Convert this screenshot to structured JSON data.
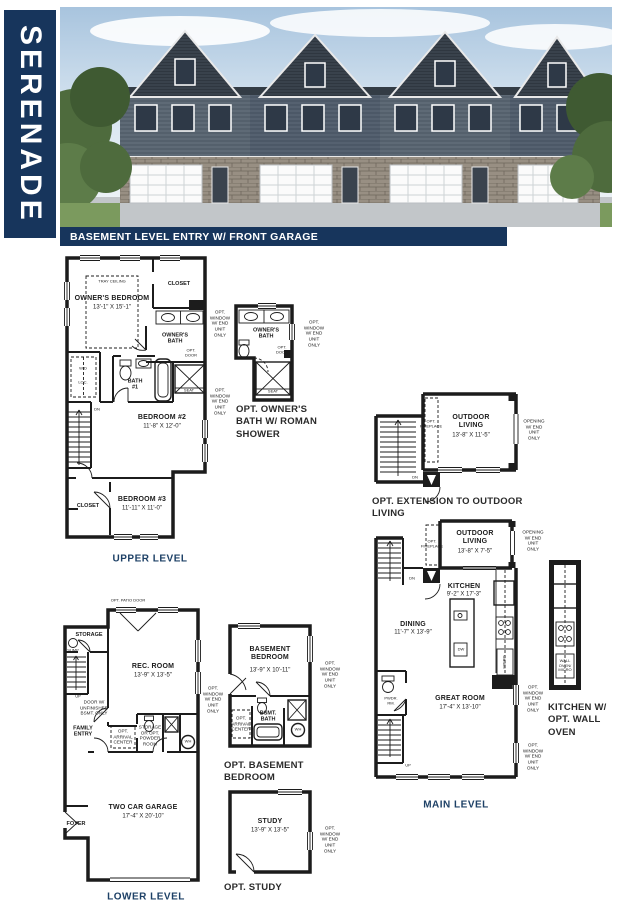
{
  "title": "SERENADE",
  "banner": "BASEMENT LEVEL ENTRY W/ FRONT GARAGE",
  "colors": {
    "navy": "#17355c",
    "caption_blue": "#1d4066"
  },
  "upper": {
    "caption": "UPPER LEVEL",
    "tray_ceiling": "TRAY CEILING",
    "owners_bedroom": "OWNER'S BEDROOM",
    "owners_bedroom_dims": "13'-1\" X 15'-1\"",
    "closet_top": "CLOSET",
    "owners_bath": "OWNER'S\nBATH",
    "opt_door": "OPT.\nDOOR",
    "seat": "SEAT",
    "wd": "W/D",
    "loc": "LOC.",
    "bath1": "BATH\n#1",
    "dn": "DN",
    "bedroom2": "BEDROOM #2",
    "bedroom2_dims": "11'-8\" X 12'-0\"",
    "bedroom3": "BEDROOM #3",
    "bedroom3_dims": "11'-11\" X 11'-0\"",
    "closet_b3": "CLOSET",
    "opt_window_a": "OPT.\nWINDOW\nW/ END\nUNIT ONLY",
    "opt_window_b": "OPT.\nWINDOW\nW/ END\nUNIT ONLY"
  },
  "opt_owners_bath": {
    "caption": "OPT. OWNER'S\nBATH W/ ROMAN\nSHOWER",
    "owners_bath": "OWNER'S\nBATH",
    "opt_door": "OPT.\nDOOR",
    "seat": "SEAT",
    "opt_window": "OPT.\nWINDOW\nW/ END\nUNIT ONLY"
  },
  "opt_outdoor": {
    "caption": "OPT. EXTENSION TO OUTDOOR\nLIVING",
    "room": "OUTDOOR\nLIVING",
    "dims": "13'-8\" X 11'-5\"",
    "opt_fireplace": "OPT.\nFIREPLACE",
    "opening": "OPENING\nW/ END\nUNIT ONLY",
    "dn": "DN"
  },
  "main": {
    "caption": "MAIN LEVEL",
    "outdoor": "OUTDOOR\nLIVING",
    "outdoor_dims": "13'-8\" X 7'-5\"",
    "opt_fireplace": "OPT.\nFIREPLACE",
    "opening": "OPENING\nW/ END\nUNIT ONLY",
    "dn": "DN",
    "up": "UP",
    "kitchen": "KITCHEN",
    "kitchen_dims": "9'-2\" X 17'-3\"",
    "dw": "DW",
    "micro": "MICRO",
    "dining": "DINING",
    "dining_dims": "11'-7\" X 13'-9\"",
    "pwdr": "PWDR.\nRM.",
    "great_room": "GREAT ROOM",
    "great_room_dims": "17'-4\" X 13'-10\"",
    "opt_window_a": "OPT.\nWINDOW\nW/ END\nUNIT ONLY",
    "opt_window_b": "OPT.\nWINDOW\nW/ END\nUNIT ONLY"
  },
  "opt_wall_oven": {
    "caption": "KITCHEN W/\nOPT. WALL\nOVEN",
    "label": "WALL\nOVEN/\nMICRO"
  },
  "lower": {
    "caption": "LOWER LEVEL",
    "opt_patio_door": "OPT. PATIO DOOR",
    "storage": "STORAGE",
    "sump": "SUMP",
    "rec_room": "REC. ROOM",
    "rec_room_dims": "13'-9\" X 13'-5\"",
    "door_note": "DOOR W/\nUNFINISHED\nBSMT. ONLY",
    "family_entry": "FAMILY\nENTRY",
    "opt_arrival": "OPT.\nARRIVAL\nCENTER",
    "storage_powder": "STORAGE\nOR OPT.\nPOWDER\nROOM",
    "wh": "WH",
    "garage": "TWO CAR GARAGE",
    "garage_dims": "17'-4\" X 20'-10\"",
    "foyer": "FOYER",
    "up": "UP",
    "opt_window": "OPT.\nWINDOW\nW/ END\nUNIT ONLY"
  },
  "opt_basement_bedroom": {
    "caption": "OPT. BASEMENT BEDROOM",
    "room": "BASEMENT\nBEDROOM",
    "dims": "13'-9\" X 10'-11\"",
    "bsmt_bath": "BSMT.\nBATH",
    "opt_arrival": "OPT.\nARRIVAL\nCENTER",
    "wh": "WH",
    "opt_window": "OPT.\nWINDOW\nW/ END\nUNIT ONLY"
  },
  "opt_study": {
    "caption": "OPT. STUDY",
    "room": "STUDY",
    "dims": "13'-9\" X 13'-5\"",
    "opt_window": "OPT.\nWINDOW\nW/ END\nUNIT ONLY"
  }
}
